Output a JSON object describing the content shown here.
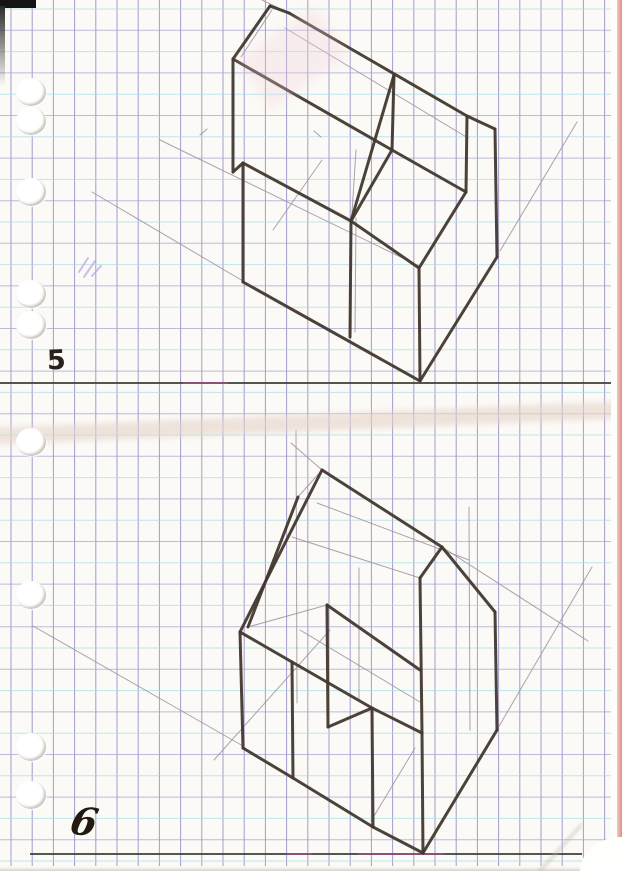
{
  "page": {
    "width": 622,
    "height": 871,
    "background": "#fcfaf6",
    "label_top": "5",
    "label_bottom": "6"
  },
  "grid": {
    "pitch_x": 21.2,
    "pitch_y": 21.3,
    "offset_x": 11,
    "offset_y": 9,
    "right_limit": 613,
    "bottom_limit": 866,
    "vertical_color": "#8c84c2",
    "vertical_opacity": 0.8,
    "horizontal_color_a": "#a6dde5",
    "horizontal_color_b": "#a8a1d1",
    "horizontal_opacity": 0.72
  },
  "edges": {
    "right_pink": "#dd8f88",
    "right_pink_inner": "#f3c9bf",
    "corner_mark": "#141414",
    "bottom_edge": "#d8d2ca"
  },
  "ground_lines": {
    "color": "#41453b",
    "top": [
      0,
      383,
      613,
      383
    ],
    "bottom": [
      30,
      854,
      582,
      854
    ],
    "accent_color": "#b8509f",
    "accents": [
      [
        183,
        383,
        228,
        383
      ],
      [
        286,
        854,
        312,
        854
      ],
      [
        358,
        854,
        444,
        854
      ]
    ]
  },
  "figures": [
    {
      "id": "figure-5-drawing",
      "ink_color": "#42382e",
      "ink_width": 3,
      "pencil_color": "#9e90a2",
      "pencil_width": 1,
      "thick": [
        [
          270,
          6,
          289,
          13
        ],
        [
          270,
          6,
          233,
          59
        ],
        [
          233,
          59,
          233,
          172
        ],
        [
          233,
          172,
          243,
          163
        ],
        [
          243,
          163,
          243,
          282
        ],
        [
          243,
          282,
          420,
          381
        ],
        [
          420,
          381,
          497,
          257
        ],
        [
          497,
          257,
          495,
          129
        ],
        [
          495,
          129,
          467,
          116
        ],
        [
          289,
          13,
          467,
          116
        ],
        [
          467,
          116,
          466,
          192
        ],
        [
          466,
          192,
          392,
          150
        ],
        [
          392,
          150,
          394,
          75
        ],
        [
          394,
          75,
          351,
          221
        ],
        [
          392,
          150,
          351,
          221
        ],
        [
          351,
          221,
          350,
          337
        ],
        [
          351,
          221,
          419,
          268
        ],
        [
          419,
          268,
          420,
          381
        ],
        [
          243,
          163,
          351,
          221
        ],
        [
          233,
          59,
          392,
          150
        ],
        [
          466,
          192,
          419,
          268
        ]
      ],
      "thin": [
        [
          92,
          192,
          243,
          281
        ],
        [
          160,
          140,
          419,
          266
        ],
        [
          262,
          0,
          289,
          13
        ],
        [
          285,
          28,
          468,
          138
        ],
        [
          500,
          251,
          577,
          122
        ],
        [
          273,
          230,
          322,
          160
        ],
        [
          356,
          150,
          352,
          213
        ],
        [
          356,
          218,
          355,
          332
        ],
        [
          272,
          10,
          241,
          57
        ]
      ]
    },
    {
      "id": "figure-6-drawing",
      "ink_color": "#42382e",
      "ink_width": 3,
      "pencil_color": "#9e90a2",
      "pencil_width": 1,
      "thick": [
        [
          322,
          470,
          442,
          547
        ],
        [
          322,
          470,
          240,
          632
        ],
        [
          442,
          547,
          495,
          612
        ],
        [
          442,
          547,
          420,
          578
        ],
        [
          420,
          578,
          422,
          733
        ],
        [
          422,
          733,
          372,
          708
        ],
        [
          372,
          708,
          373,
          827
        ],
        [
          422,
          733,
          423,
          853
        ],
        [
          373,
          827,
          423,
          853
        ],
        [
          423,
          853,
          497,
          730
        ],
        [
          497,
          730,
          495,
          612
        ],
        [
          240,
          632,
          243,
          748
        ],
        [
          243,
          748,
          293,
          778
        ],
        [
          293,
          778,
          373,
          827
        ],
        [
          293,
          778,
          292,
          662
        ],
        [
          292,
          662,
          240,
          632
        ],
        [
          298,
          497,
          248,
          627
        ],
        [
          327,
          605,
          328,
          727
        ],
        [
          327,
          605,
          420,
          670
        ],
        [
          328,
          727,
          372,
          708
        ],
        [
          292,
          662,
          372,
          708
        ]
      ],
      "thin": [
        [
          291,
          443,
          322,
          470
        ],
        [
          442,
          547,
          588,
          641
        ],
        [
          317,
          503,
          469,
          560
        ],
        [
          296,
          430,
          297,
          703
        ],
        [
          469,
          507,
          470,
          730
        ],
        [
          359,
          568,
          359,
          700
        ],
        [
          33,
          626,
          243,
          746
        ],
        [
          592,
          567,
          498,
          728
        ],
        [
          292,
          537,
          420,
          578
        ],
        [
          248,
          627,
          327,
          605
        ],
        [
          298,
          497,
          322,
          470
        ],
        [
          415,
          748,
          371,
          821
        ],
        [
          214,
          760,
          330,
          630
        ],
        [
          300,
          630,
          420,
          702
        ]
      ]
    }
  ],
  "marks": {
    "scribble_color": "#b7a5e3",
    "scribbles": [
      [
        79,
        272,
        88,
        258
      ],
      [
        84,
        277,
        95,
        261
      ],
      [
        92,
        276,
        101,
        266
      ]
    ],
    "pencil_color": "#8f8c88",
    "pencil_ticks": [
      [
        200,
        135,
        207,
        129
      ],
      [
        314,
        131,
        321,
        137
      ]
    ]
  },
  "holes": {
    "ys": [
      92,
      121,
      192,
      294,
      325,
      442,
      595,
      747,
      795
    ]
  }
}
